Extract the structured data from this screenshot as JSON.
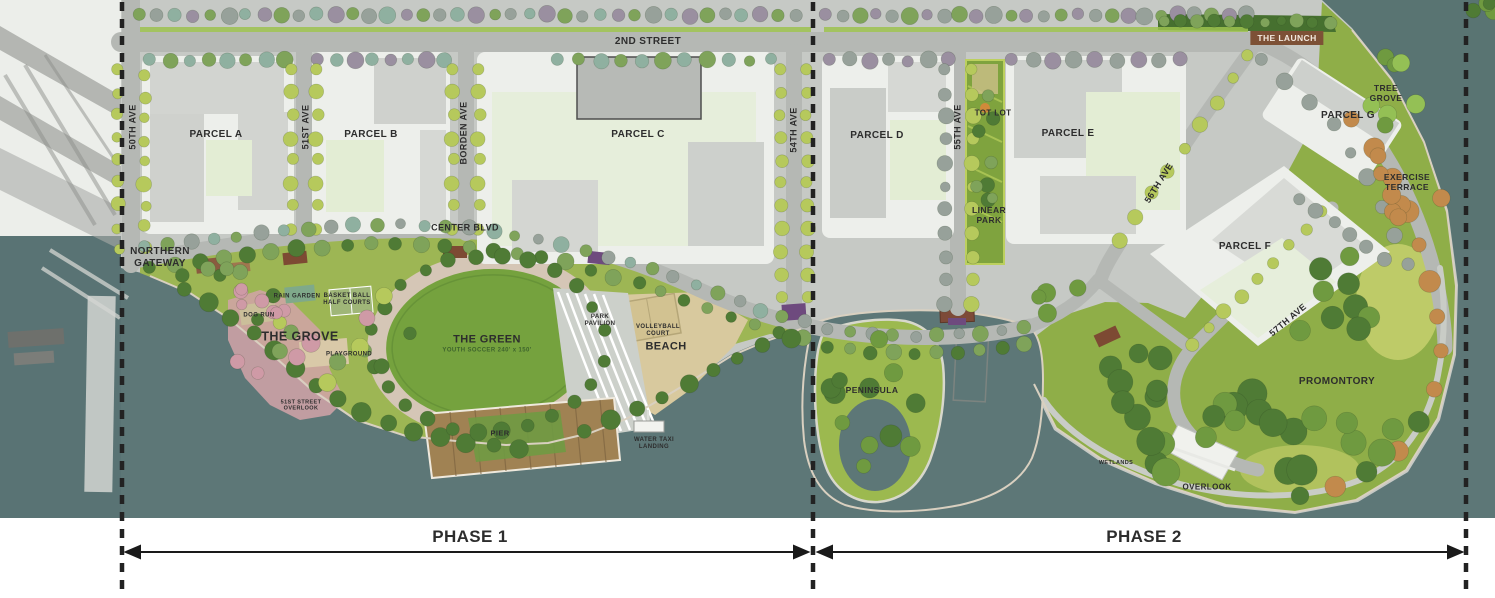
{
  "map": {
    "labels": [
      {
        "id": "street-2nd",
        "text": "2ND STREET",
        "x": 648,
        "y": 42,
        "s": 10
      },
      {
        "id": "ave-50th",
        "text": "50TH AVE",
        "x": 133,
        "y": 127,
        "s": 9,
        "rot": -90
      },
      {
        "id": "ave-51st",
        "text": "51ST AVE",
        "x": 306,
        "y": 127,
        "s": 9,
        "rot": -90
      },
      {
        "id": "ave-borden",
        "text": "BORDEN AVE",
        "x": 464,
        "y": 133,
        "s": 9,
        "rot": -90
      },
      {
        "id": "ave-54th",
        "text": "54TH AVE",
        "x": 794,
        "y": 130,
        "s": 9,
        "rot": -90
      },
      {
        "id": "ave-55th",
        "text": "55TH AVE",
        "x": 958,
        "y": 127,
        "s": 9,
        "rot": -90
      },
      {
        "id": "ave-56th",
        "text": "56TH AVE",
        "x": 1159,
        "y": 183,
        "s": 9,
        "rot": -58
      },
      {
        "id": "ave-57th",
        "text": "57TH AVE",
        "x": 1288,
        "y": 320,
        "s": 9,
        "rot": -40
      },
      {
        "id": "center-blvd",
        "text": "CENTER BLVD",
        "x": 465,
        "y": 228,
        "s": 9
      },
      {
        "id": "parcel-a",
        "text": "PARCEL A",
        "x": 216,
        "y": 135,
        "s": 10
      },
      {
        "id": "parcel-b",
        "text": "PARCEL B",
        "x": 371,
        "y": 135,
        "s": 10
      },
      {
        "id": "parcel-c",
        "text": "PARCEL C",
        "x": 638,
        "y": 135,
        "s": 10
      },
      {
        "id": "parcel-d",
        "text": "PARCEL D",
        "x": 877,
        "y": 136,
        "s": 10
      },
      {
        "id": "parcel-e",
        "text": "PARCEL E",
        "x": 1068,
        "y": 134,
        "s": 10
      },
      {
        "id": "parcel-f",
        "text": "PARCEL F",
        "x": 1245,
        "y": 247,
        "s": 10
      },
      {
        "id": "parcel-g",
        "text": "PARCEL G",
        "x": 1348,
        "y": 116,
        "s": 10
      },
      {
        "id": "the-launch",
        "text": "THE LAUNCH",
        "x": 1287,
        "y": 38,
        "s": 8.5,
        "bg": "#7d5136",
        "color": "#f3e9df"
      },
      {
        "id": "tree-grove",
        "text": "TREE\nGROVE",
        "x": 1386,
        "y": 93,
        "s": 8.5
      },
      {
        "id": "exercise-terrace",
        "text": "EXERCISE\nTERRACE",
        "x": 1407,
        "y": 182,
        "s": 8.5
      },
      {
        "id": "northern-gateway",
        "text": "NORTHERN\nGATEWAY",
        "x": 160,
        "y": 258,
        "s": 10
      },
      {
        "id": "the-grove",
        "text": "THE GROVE",
        "x": 300,
        "y": 337,
        "s": 12.5
      },
      {
        "id": "rain-garden",
        "text": "RAIN GARDEN",
        "x": 297,
        "y": 297,
        "s": 6
      },
      {
        "id": "dog-run",
        "text": "DOG RUN",
        "x": 259,
        "y": 316,
        "s": 6
      },
      {
        "id": "basketball-half-courts",
        "text": "BASKET BALL\nHALF COURTS",
        "x": 347,
        "y": 300,
        "s": 6
      },
      {
        "id": "playground",
        "text": "PLAYGROUND",
        "x": 349,
        "y": 355,
        "s": 6
      },
      {
        "id": "the-green",
        "text": "THE GREEN",
        "x": 487,
        "y": 340,
        "s": 11
      },
      {
        "id": "the-green-sub",
        "text": "YOUTH SOCCER 240' x 150'",
        "x": 487,
        "y": 351,
        "s": 6,
        "color": "#3e642c"
      },
      {
        "id": "park-pavilion",
        "text": "PARK\nPAVILION",
        "x": 600,
        "y": 321,
        "s": 6
      },
      {
        "id": "volleyball-court",
        "text": "VOLLEYBALL\nCOURT",
        "x": 658,
        "y": 331,
        "s": 6
      },
      {
        "id": "beach",
        "text": "BEACH",
        "x": 666,
        "y": 347,
        "s": 11
      },
      {
        "id": "pier",
        "text": "PIER",
        "x": 500,
        "y": 434,
        "s": 7.5
      },
      {
        "id": "water-taxi-landing",
        "text": "WATER TAXI\nLANDING",
        "x": 654,
        "y": 444,
        "s": 6
      },
      {
        "id": "street-overlook",
        "text": "51ST STREET\nOVERLOOK",
        "x": 301,
        "y": 406,
        "s": 5.5
      },
      {
        "id": "peninsula",
        "text": "PENINSULA",
        "x": 872,
        "y": 390,
        "s": 8.5
      },
      {
        "id": "promontory",
        "text": "PROMONTORY",
        "x": 1337,
        "y": 382,
        "s": 10
      },
      {
        "id": "overlook",
        "text": "OVERLOOK",
        "x": 1207,
        "y": 487,
        "s": 8
      },
      {
        "id": "wetlands",
        "text": "WETLANDS",
        "x": 1116,
        "y": 463,
        "s": 5.5
      },
      {
        "id": "tot-lot",
        "text": "TOT LOT",
        "x": 993,
        "y": 113,
        "s": 8
      },
      {
        "id": "linear-park",
        "text": "LINEAR\nPARK",
        "x": 989,
        "y": 215,
        "s": 8.5
      },
      {
        "id": "phase-1",
        "text": "PHASE 1",
        "x": 470,
        "y": 537,
        "s": 17,
        "w": 800
      },
      {
        "id": "phase-2",
        "text": "PHASE 2",
        "x": 1144,
        "y": 537,
        "s": 17,
        "w": 800
      }
    ]
  },
  "colors": {
    "water": "#5d7777",
    "land": "#c6c9c5",
    "road": "#b5b8b4",
    "lawn": "#9db654",
    "park-green": "#8fae48",
    "oval-green": "#75a23e",
    "beach": "#d8c99e",
    "pale-block": "#e3edd4",
    "pad": "#edefeb",
    "phase-line": "#222222",
    "label": "#2d2d2d",
    "launch-bg": "#7d5136"
  }
}
